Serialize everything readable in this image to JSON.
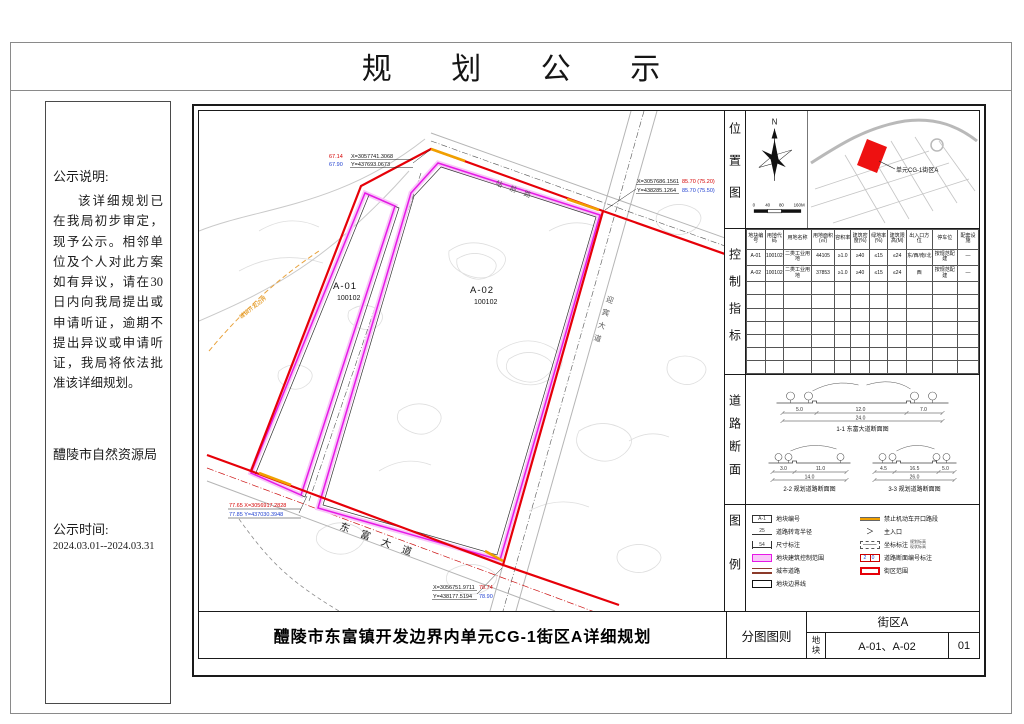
{
  "page_title": "规 划 公 示",
  "notice": {
    "heading": "公示说明:",
    "body": "该详细规划已在我局初步审定，现予公示。相邻单位及个人对此方案如有异议，请在30日内向我局提出或申请听证，逾期不提出异议或申请听证，我局将依法批准该详细规划。",
    "agency": "醴陵市自然资源局",
    "time_label": "公示时间:",
    "time_value": "2024.03.01--2024.03.31"
  },
  "map": {
    "parcels": [
      {
        "id": "A-01",
        "code": "100102"
      },
      {
        "id": "A-02",
        "code": "100102"
      }
    ],
    "road_labels": {
      "bottom": "东富大道",
      "top": "站前路",
      "right": "迎宾大道"
    },
    "boundary_label": "城镇开发边界",
    "annotations": {
      "top": {
        "elev_red": "67.14",
        "elev_blue": "67.90",
        "x": "X=3057741.3068",
        "y": "Y=437693.0673"
      },
      "right": {
        "x": "X=3057686.1561",
        "x_elev": "85.70 (75.20)",
        "y": "Y=438285.1264",
        "y_elev": "85.70 (75.50)"
      },
      "bottom_left": {
        "x": "77.65 X=3056917.2828",
        "y": "77.85 Y=437030.3948"
      },
      "bottom_center": {
        "x": "X=3056751.9711",
        "x_elev": "78.74",
        "y": "Y=438177.5194",
        "y_elev": "78.90"
      }
    }
  },
  "location": {
    "label": "位置图",
    "north": "N",
    "scale_labels": [
      "0",
      "40",
      "80",
      "160M"
    ],
    "callout": "单元CG-1街区A"
  },
  "indicators": {
    "label": "控制指标",
    "headers": [
      "地块编号",
      "用地代码",
      "用地名称",
      "用地面积(㎡)",
      "容积率",
      "建筑密度(%)",
      "绿地率(%)",
      "建筑限高(M)",
      "出入口方位",
      "停车位",
      "配套设施"
    ],
    "rows": [
      [
        "A-01",
        "100102",
        "二类工业用地",
        "44105",
        "≥1.0",
        "≥40",
        "≤15",
        "≤24",
        "东/西/南/北",
        "按规范配建",
        "—"
      ],
      [
        "A-02",
        "100102",
        "二类工业用地",
        "37853",
        "≥1.0",
        "≥40",
        "≤15",
        "≤24",
        "西",
        "按规范配建",
        "—"
      ]
    ],
    "empty_rows": 7
  },
  "sections": {
    "label": "道路断面",
    "items": [
      {
        "caption": "1-1 东富大道断面图",
        "d1": "5.0",
        "d2": "12.0",
        "d3": "7.0",
        "total": "24.0"
      },
      {
        "caption": "2-2 规划道路断面图",
        "d1": "3.0",
        "d2": "11.0",
        "d3": "",
        "total": "14.0"
      },
      {
        "caption": "3-3 规划道路断面图",
        "d1": "4.5",
        "d2": "16.5",
        "d3": "5.0",
        "total": "26.0"
      }
    ]
  },
  "legend": {
    "label": "图例",
    "left": [
      {
        "sym": "parcel-no",
        "sym_text": "A-1",
        "label": "地块编号"
      },
      {
        "sym": "turn-radius",
        "sym_text": "25",
        "label": "道路转弯半径"
      },
      {
        "sym": "dimension",
        "sym_text": "54",
        "label": "尺寸标注"
      },
      {
        "sym": "control-band",
        "sym_text": "",
        "label": "地块建筑控制范围"
      },
      {
        "sym": "city-road",
        "sym_text": "",
        "label": "城市道路"
      },
      {
        "sym": "parcel-boundary",
        "sym_text": "",
        "label": "地块边界线"
      }
    ],
    "right": [
      {
        "sym": "no-opening",
        "sym_text": "",
        "label": "禁止机动车开口路段"
      },
      {
        "sym": "main-entrance",
        "sym_text": "＞",
        "label": "主入口"
      },
      {
        "sym": "coord-label",
        "sym_text": "",
        "label": "坐标标注",
        "sym_note": "规划标高|现状标高"
      },
      {
        "sym": "section-no",
        "sym_text": "2 0",
        "label": "道路断面编号标注"
      },
      {
        "sym": "block-extent",
        "sym_text": "",
        "label": "街区范围"
      }
    ]
  },
  "titleblock": {
    "main_title": "醴陵市东富镇开发边界内单元CG-1街区A详细规划",
    "sheet_type": "分图图则",
    "block_name": "街区A",
    "parcel_label": "地块",
    "parcel_value": "A-01、A-02",
    "sheet_no": "01"
  },
  "colors": {
    "boundary_red": "#e60008",
    "parcel_magenta": "#e619e6",
    "band_pink": "#f9c6f9",
    "no_open_orange": "#f0a000",
    "coord_red": "#d40000",
    "coord_blue": "#2040d0",
    "location_parcel_fill": "#ee1111"
  }
}
